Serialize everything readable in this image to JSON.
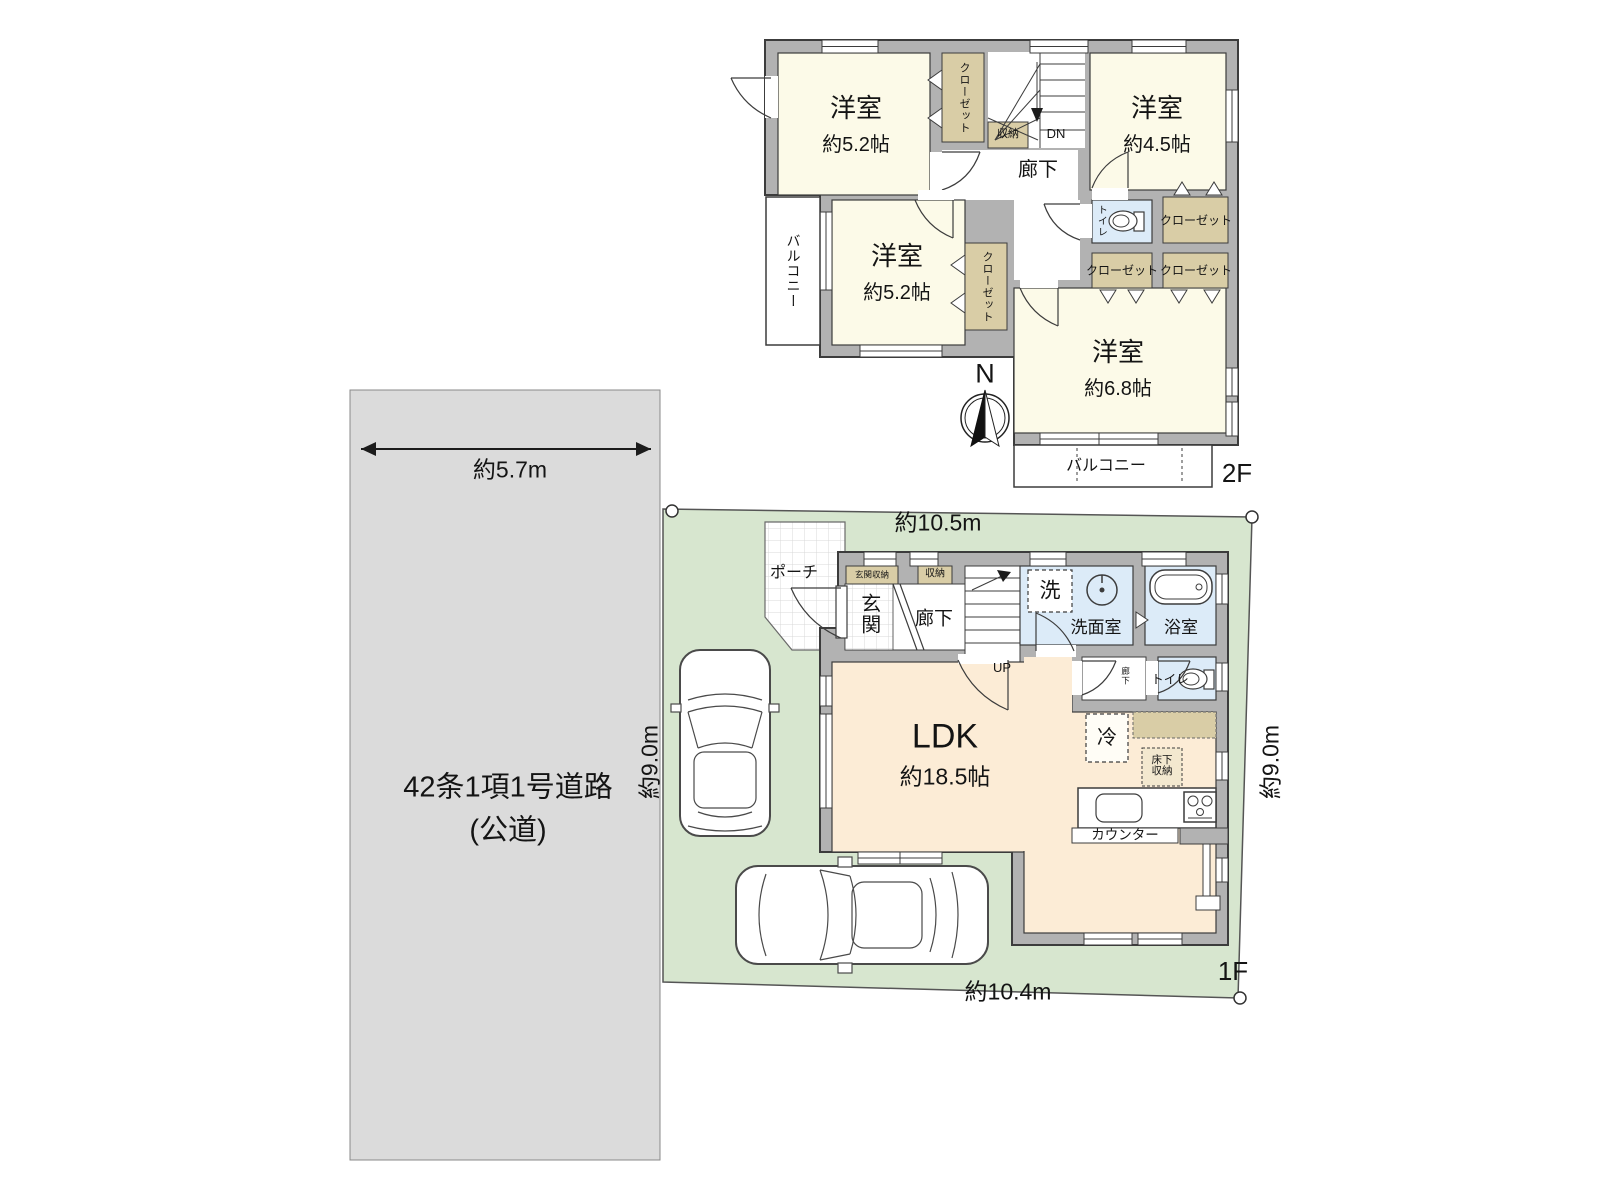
{
  "road": {
    "name_line1": "42条1項1号道路",
    "name_line2": "(公道)",
    "width": "約5.7m"
  },
  "site": {
    "top_width": "約10.5m",
    "bottom_width": "約10.4m",
    "left_depth": "約9.0m",
    "right_depth": "約9.0m"
  },
  "compass": {
    "north": "N"
  },
  "floor2": {
    "floor_label": "2F",
    "room_a": {
      "name": "洋室",
      "size": "約5.2帖"
    },
    "room_b": {
      "name": "洋室",
      "size": "約4.5帖"
    },
    "room_c": {
      "name": "洋室",
      "size": "約5.2帖"
    },
    "room_d": {
      "name": "洋室",
      "size": "約6.8帖"
    },
    "closet": "クローゼット",
    "storage": "収納",
    "hallway": "廊下",
    "toilet": "トイレ",
    "balcony": "バルコニー",
    "stairs_down": "DN"
  },
  "floor1": {
    "floor_label": "1F",
    "ldk": {
      "name": "LDK",
      "size": "約18.5帖"
    },
    "porch": "ポーチ",
    "entrance": "玄関",
    "entrance_storage": "玄関収納",
    "storage": "収納",
    "hallway": "廊下",
    "hallway_small": "廊下",
    "stairs_up": "UP",
    "washer": "洗",
    "washroom": "洗面室",
    "bathroom": "浴室",
    "toilet": "トイレ",
    "refrigerator": "冷",
    "underfloor_storage_line1": "床下",
    "underfloor_storage_line2": "収納",
    "counter": "カウンター"
  },
  "colors": {
    "road_gray": "#dbdbdb",
    "site_green": "#d7e6cf",
    "wall_gray": "#b2b2b2",
    "room_cream": "#fcfae8",
    "water_blue": "#dcebf8",
    "ldk_peach": "#fcecd6",
    "closet_tan": "#d9cda6",
    "outline": "#3c3c3c"
  }
}
